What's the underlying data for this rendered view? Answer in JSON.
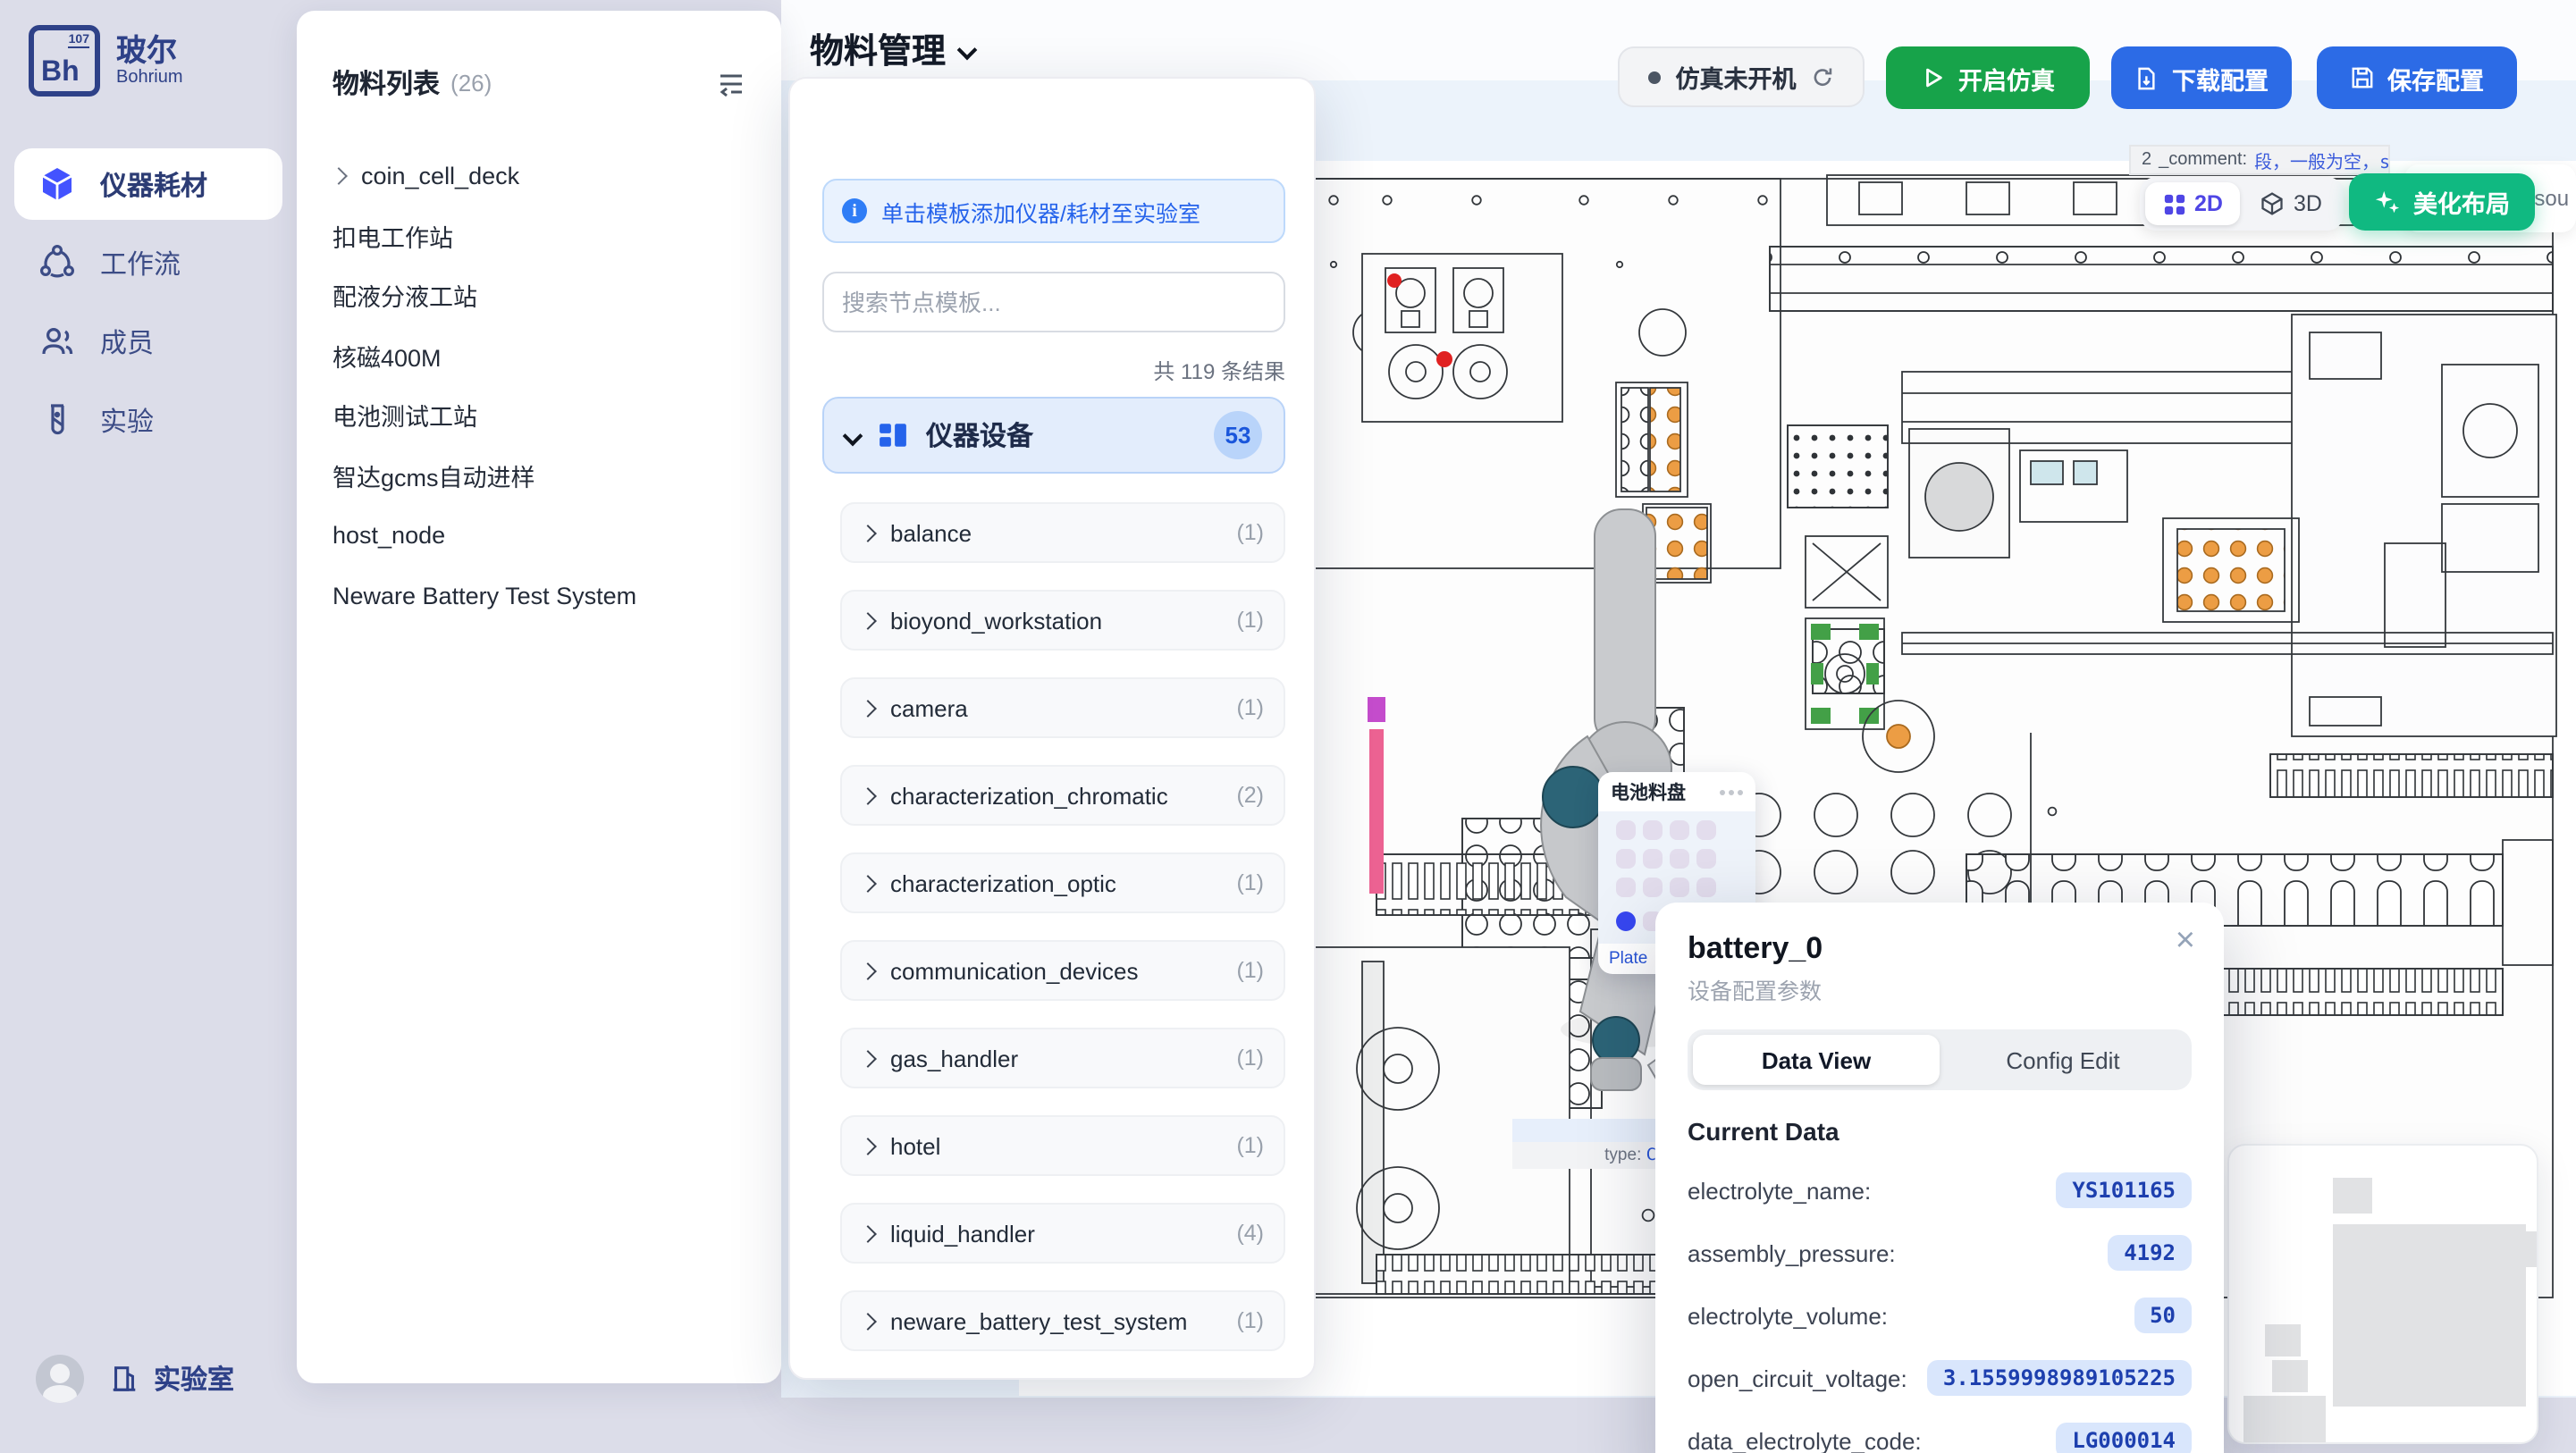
{
  "colors": {
    "primary_blue": "#2c6be6",
    "success_green": "#17a34a",
    "emerald_beautify": "#10b981",
    "indigo_active_2d": "#4f46e5",
    "category_badge_bg": "#b9d4fa",
    "selected_slot_blue": "#3747f0",
    "value_pill_bg": "#d9e6fc",
    "value_pill_text": "#1d3fae"
  },
  "sidebar": {
    "logo": {
      "element_symbol": "Bh",
      "element_number": "107",
      "brand_zh": "玻尔",
      "brand_en": "Bohrium"
    },
    "items": [
      {
        "label": "仪器耗材",
        "active": true
      },
      {
        "label": "工作流",
        "active": false
      },
      {
        "label": "成员",
        "active": false
      },
      {
        "label": "实验",
        "active": false
      }
    ],
    "footer": {
      "lab": "实验室"
    }
  },
  "material_panel": {
    "title": "物料列表",
    "count": "(26)",
    "items": [
      {
        "label": "coin_cell_deck",
        "expandable": true
      },
      {
        "label": "扣电工作站"
      },
      {
        "label": "配液分液工站"
      },
      {
        "label": "核磁400M"
      },
      {
        "label": "电池测试工站"
      },
      {
        "label": "智达gcms自动进样"
      },
      {
        "label": "host_node"
      },
      {
        "label": "Neware Battery Test System"
      }
    ]
  },
  "header": {
    "title": "物料管理",
    "status": "仿真未开机",
    "start_sim": "开启仿真",
    "download": "下载配置",
    "save": "保存配置"
  },
  "template_panel": {
    "banner": "单击模板添加仪器/耗材至实验室",
    "search_placeholder": "搜索节点模板...",
    "result_count": "共 119 条结果",
    "category": {
      "label": "仪器设备",
      "badge": "53"
    },
    "items": [
      {
        "label": "balance",
        "count": "(1)"
      },
      {
        "label": "bioyond_workstation",
        "count": "(1)"
      },
      {
        "label": "camera",
        "count": "(1)"
      },
      {
        "label": "characterization_chromatic",
        "count": "(2)"
      },
      {
        "label": "characterization_optic",
        "count": "(1)"
      },
      {
        "label": "communication_devices",
        "count": "(1)"
      },
      {
        "label": "gas_handler",
        "count": "(1)"
      },
      {
        "label": "hotel",
        "count": "(1)"
      },
      {
        "label": "liquid_handler",
        "count": "(4)"
      },
      {
        "label": "neware_battery_test_system",
        "count": "(1)"
      }
    ]
  },
  "canvas": {
    "view_toggle": {
      "d2": "2D",
      "d3": "3D"
    },
    "beautify": "美化布局",
    "comment_tooltip": {
      "prefix": "2",
      "key": "_comment:",
      "value": "段，一般为空，stat",
      "truncated_line": "法此固定"
    },
    "partial_label": "esou",
    "type_tooltip": {
      "label": "type: ",
      "value": "Coi"
    },
    "tray": {
      "title": "电池料盘",
      "slot_link": "Plate"
    }
  },
  "popup": {
    "title": "battery_0",
    "subtitle": "设备配置参数",
    "tabs": {
      "data_view": "Data View",
      "config_edit": "Config Edit"
    },
    "section": "Current Data",
    "rows": [
      {
        "label": "electrolyte_name:",
        "value": "YS101165"
      },
      {
        "label": "assembly_pressure:",
        "value": "4192"
      },
      {
        "label": "electrolyte_volume:",
        "value": "50"
      },
      {
        "label": "open_circuit_voltage:",
        "value": "3.1559998989105225"
      },
      {
        "label": "data_electrolyte_code:",
        "value": "LG000014"
      }
    ]
  }
}
